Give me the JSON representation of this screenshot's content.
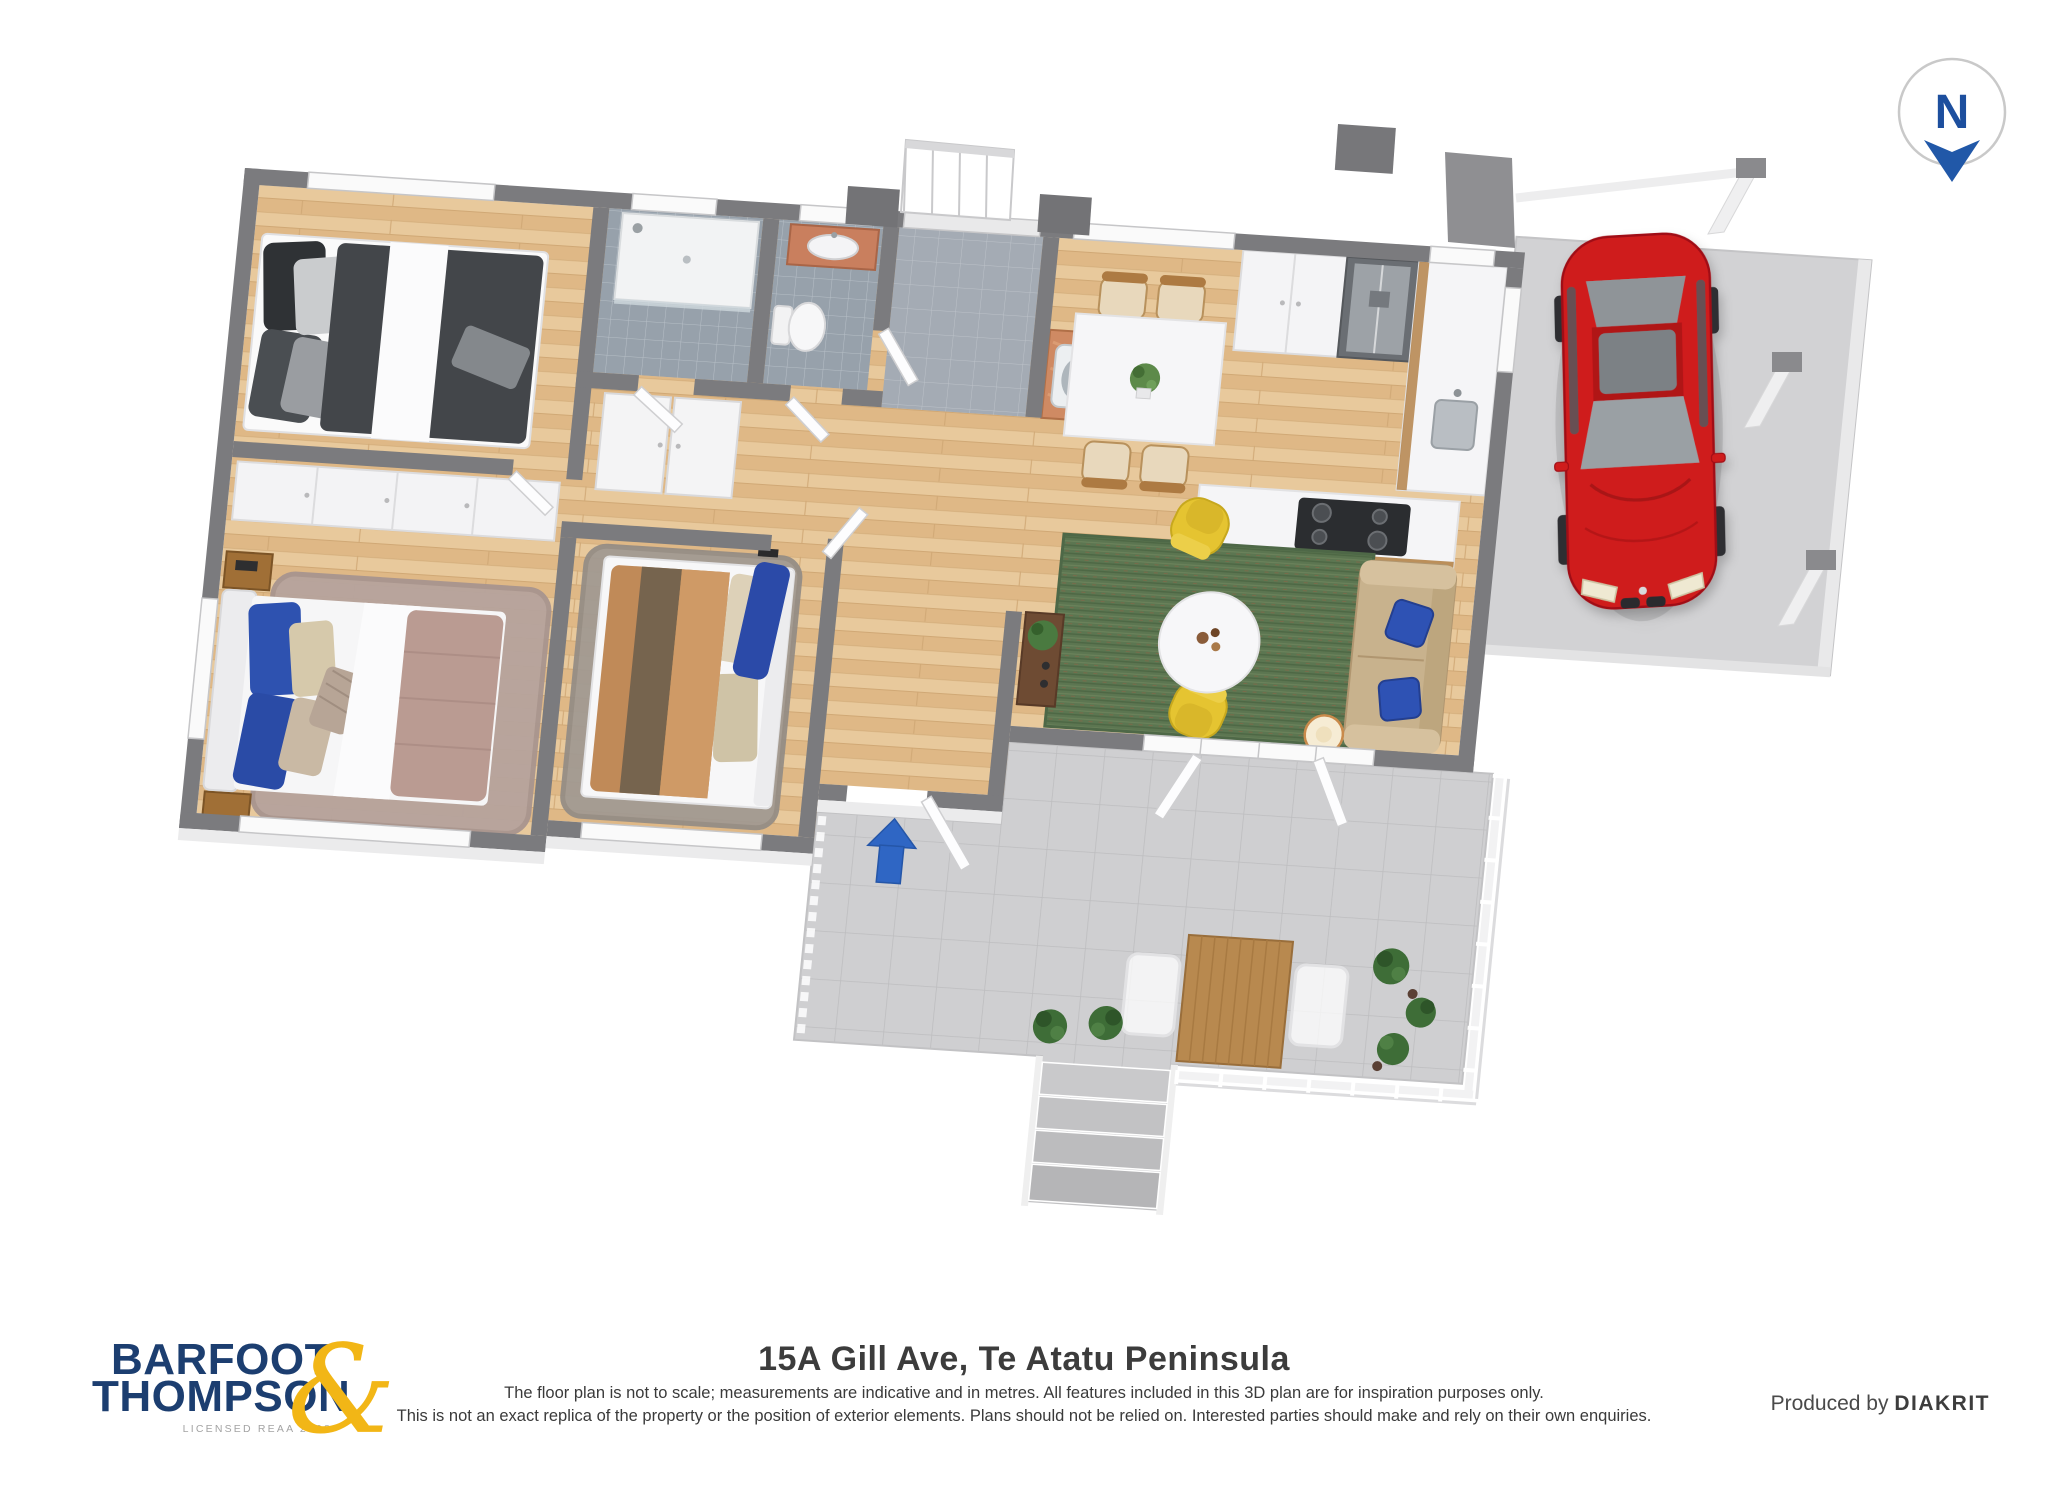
{
  "compass": {
    "letter": "N",
    "ring_color": "#c9c9c9",
    "letter_color": "#1d4f9e",
    "arrow_color": "#2158a8"
  },
  "entry_arrow": {
    "direction": "up",
    "color": "#2f66c4"
  },
  "footer": {
    "title": "15A Gill Ave, Te Atatu Peninsula",
    "disclaimer_line1": "The floor plan is not to scale; measurements are indicative and in metres. All features included in this 3D plan are for inspiration purposes only.",
    "disclaimer_line2": "This is not an exact replica of the property or the position of exterior elements. Plans should not be relied on. Interested parties should make and rely on their own enquiries.",
    "produced_by": {
      "prefix": "Produced by ",
      "brand": "DIAKRIT"
    },
    "logo": {
      "line1": "BARFOOT",
      "line2": "THOMPSON",
      "ampersand": "&",
      "tagline": "LICENSED REAA 2008",
      "navy": "#1c3e70",
      "gold": "#f2b616"
    }
  },
  "floorplan": {
    "style": "3d-isometric-render",
    "rooms": [
      "bedroom-1",
      "master-bedroom",
      "bedroom-3",
      "bathroom",
      "toilet",
      "entry-foyer",
      "hallway",
      "laundry-nook",
      "kitchen",
      "dining-area",
      "living-room",
      "carport",
      "deck",
      "stairs"
    ],
    "furniture": [
      "dark-double-bed",
      "mauve-double-bed",
      "tan-double-bed",
      "wardrobes",
      "linen-cupboards",
      "shower",
      "toilet",
      "vanity",
      "laundry-tub",
      "fridge",
      "kitchen-island-cooktop",
      "dining-table-4-chairs",
      "sofa-blue-cushions",
      "2-yellow-armchairs",
      "round-coffee-table",
      "floor-lamp",
      "media-console",
      "red-car",
      "outdoor-table-2-chairs",
      "potted-plants",
      "deck-railing",
      "deck-stairs"
    ],
    "palette": {
      "wall_gray": "#7b7b7e",
      "wood_floor": "#e3c08f",
      "tile_gray": "#97a1ab",
      "deck_gray": "#cfcfd1",
      "rug_green": "#5c7651",
      "armchair_yellow": "#e5c431",
      "sofa_beige": "#c8b28d",
      "pillow_blue": "#2e52b4",
      "car_red": "#cf1b1f",
      "terracotta": "#cf8a63",
      "bed_mauve": "#ba9b92",
      "bed_tan": "#c08a58",
      "bed_charcoal": "#43464a"
    }
  }
}
